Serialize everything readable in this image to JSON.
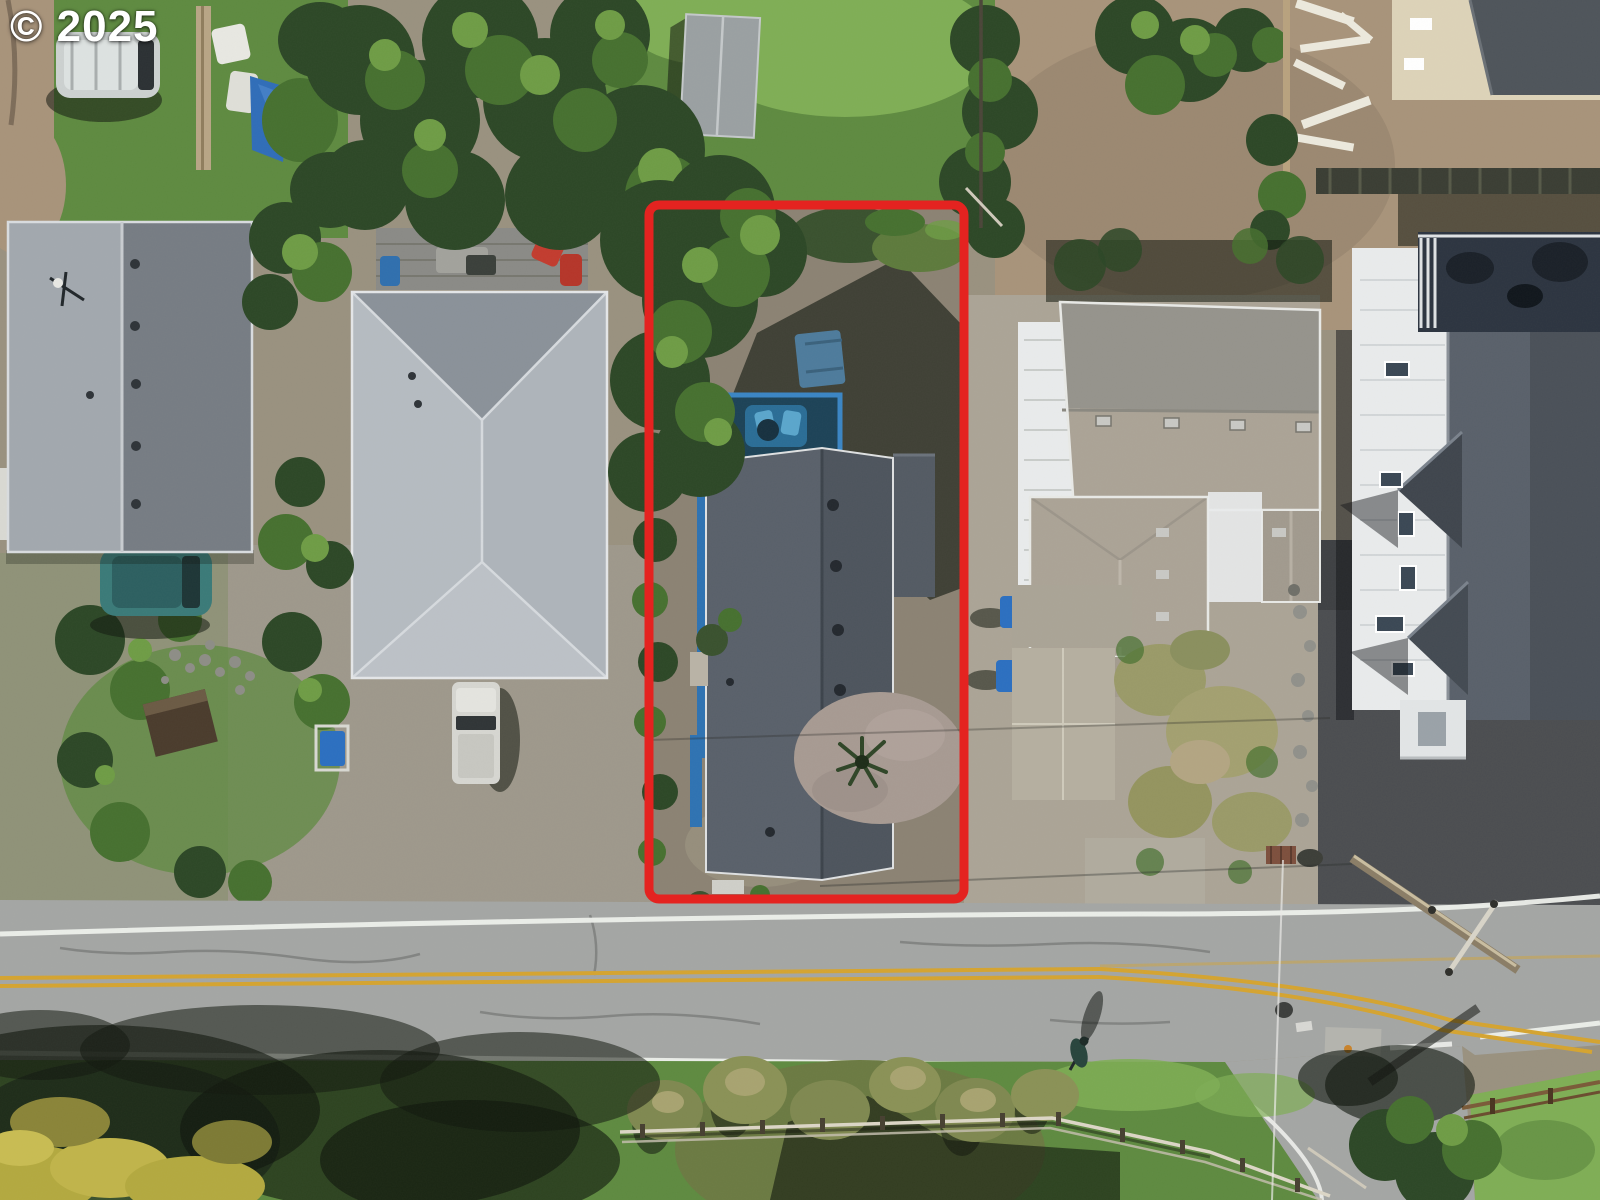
{
  "watermark": {
    "text": "© 2025"
  },
  "annotation": {
    "type": "property-boundary-outline",
    "color": "#e42320",
    "x": 649,
    "y": 205,
    "width": 315,
    "height": 694,
    "stroke_width": 9
  },
  "palette": {
    "annotation_red": "#e42320",
    "grass": "#5e8a40",
    "lawn": "#7fae55",
    "grass_dark": "#39512e",
    "tree_dark": "#2c4726",
    "tree_mid": "#46702f",
    "tree_light": "#6e9c45",
    "gravel": "#99917f",
    "dirt": "#a8937a",
    "lot_gravel": "#8b8273",
    "driveway": "#9e988b",
    "concrete": "#aba496",
    "asphalt_dark": "#4b4d50",
    "road": "#a4a6a4",
    "line_white": "#eef0ec",
    "line_yellow": "#d5a430",
    "roof_light": "#b5bbc1",
    "roof_mid": "#8a9199",
    "roof_dark": "#59606a",
    "roof_tan": "#aba396",
    "white_wall": "#e9ebec",
    "blue_accent": "#2e72b2"
  }
}
